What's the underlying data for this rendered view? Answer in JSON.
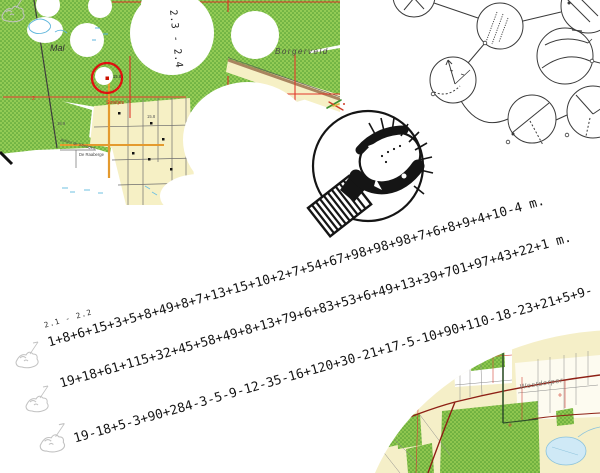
{
  "maps": {
    "top_left": {
      "range_label": "2.3 - 2.4",
      "area": "Mal",
      "region": "Borgerveld",
      "street": "Streitjes",
      "place_a": "Achter de Strengen",
      "place_b": "De Raaberge",
      "elev_a": "15.8",
      "elev_b": "15.8",
      "elev_c": "18.9",
      "grid_num": "2"
    },
    "bottom_right": {
      "town": "Rolde",
      "area": "Westdorper"
    }
  },
  "puzzle": {
    "stage_label": "2.1 - 2.2",
    "lines": [
      "1+8+6+15+3+5+8+49+8+7+13+15+10+2+7+54+67+98+98+98+7+6+8+9+4+10-4 m.",
      "19+18+61+115+32+45+58+49+8+13+79+6+83+53+6+49+13+39+701+97+43+22+1 m.",
      "19-18+5-3+90+284-3-5-9-12-35-16+120+30-21+17-5-10+90+110-18-23+21+5+9-"
    ]
  },
  "icons": {
    "center": "stamp-hedgehog-icon",
    "stage_network": "stage-circles-diagram",
    "line_marker": "faint-critter-sketch"
  },
  "colors": {
    "forest_green": "#93cb55",
    "forest_dot": "#4f9c31",
    "field_yellow": "#f6f0c5",
    "grid_red": "#e2362a",
    "road_orange": "#e49a2e",
    "road_brown": "#a9845f",
    "marker_red": "#e01010",
    "major_road_dark_red": "#8e2015",
    "lake_blue": "#cfe9f6",
    "ink_black": "#151515"
  }
}
